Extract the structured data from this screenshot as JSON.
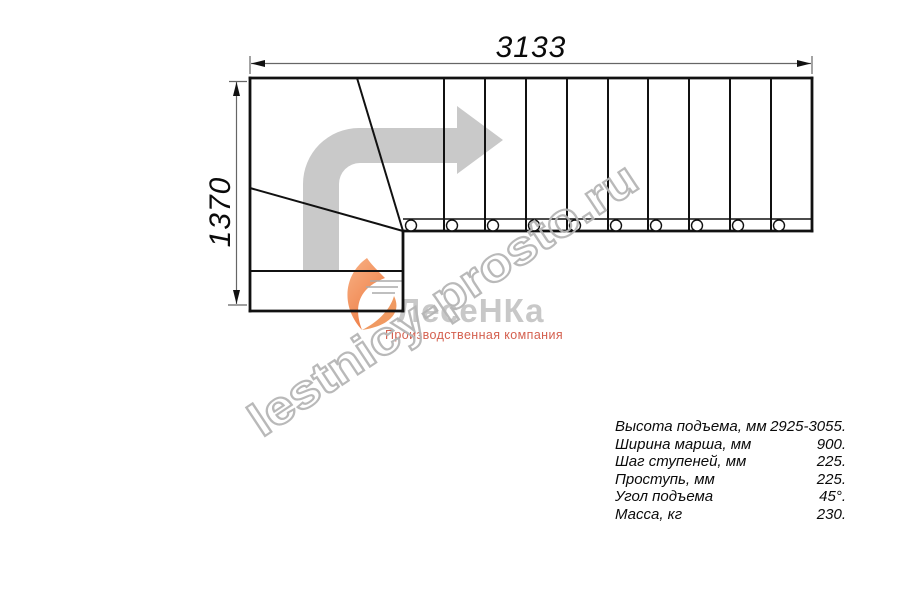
{
  "drawing": {
    "title": "L-shaped staircase plan (top view)",
    "dimensions": {
      "width_label": "3133",
      "height_label": "1370"
    },
    "structure": {
      "straight_flight_treads": 10,
      "turn_diagonal_step_edges": 2,
      "entry_steps": 2,
      "baluster_circles": 10,
      "direction_arrow": "up-then-right 90° turn"
    }
  },
  "specs": {
    "rows": [
      {
        "label": "Высота подъема, мм",
        "value": "2925-3055."
      },
      {
        "label": "Ширина марша, мм",
        "value": "900."
      },
      {
        "label": "Шаг ступеней, мм",
        "value": "225."
      },
      {
        "label": "Проступь, мм",
        "value": "225."
      },
      {
        "label": "Угол подъема",
        "value": "45°."
      },
      {
        "label": "Масса, кг",
        "value": "230."
      }
    ]
  },
  "logo": {
    "name": "ЛесеНКа",
    "subtitle": "Производственная компания"
  },
  "watermark": {
    "text": "lestnicy-prosto.ru"
  },
  "colors": {
    "line": "#111111",
    "dimension_line": "#666666",
    "direction_arrow": "#c9c9c9",
    "watermark_stroke": "#b5b5b5",
    "logo_text": "#c8c8c8",
    "logo_subtitle": "#d4604f",
    "flame_orange": "#f0854c"
  }
}
